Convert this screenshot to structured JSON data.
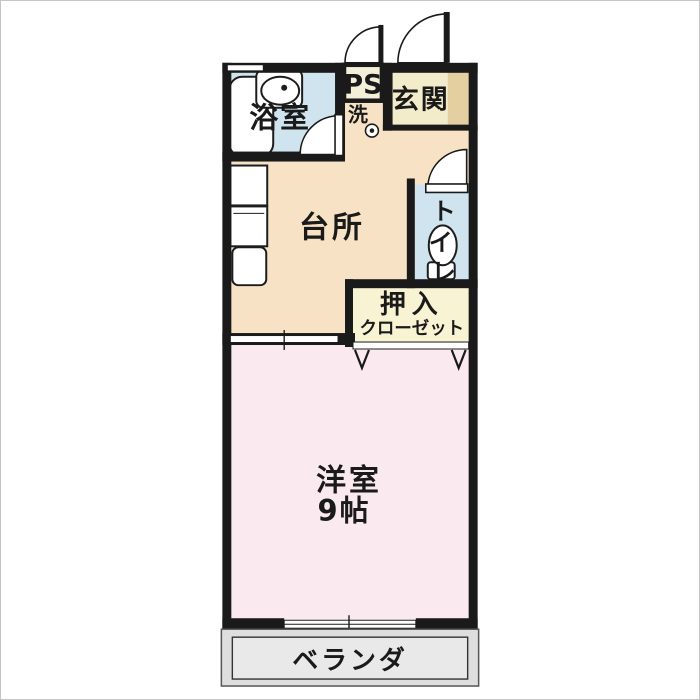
{
  "plan": {
    "rooms": {
      "bathroom": {
        "label": "浴室"
      },
      "pipe_space": {
        "label": "PS"
      },
      "entrance": {
        "label": "玄関"
      },
      "laundry": {
        "label": "洗"
      },
      "kitchen": {
        "label": "台所"
      },
      "toilet": {
        "label": "トイレ",
        "chars": [
          "ト",
          "イ",
          "レ"
        ]
      },
      "closet": {
        "label_top": "押入",
        "label_bottom": "クローゼット"
      },
      "main_room": {
        "label": "洋室",
        "size": "9帖"
      },
      "veranda": {
        "label": "ベランダ"
      }
    },
    "colors": {
      "wall": "#1a1a1a",
      "water_blue": "#cfe4ee",
      "kitchen_peach": "#f7e2c5",
      "entrance_cream": "#f3ecca",
      "entrance_step": "#e3cfa0",
      "ps_cream": "#f4efd8",
      "closet_yellow": "#f8f3d3",
      "room_pink": "#faeaef",
      "veranda_gray": "#dedede",
      "veranda_inner": "#e9e9e9"
    }
  }
}
